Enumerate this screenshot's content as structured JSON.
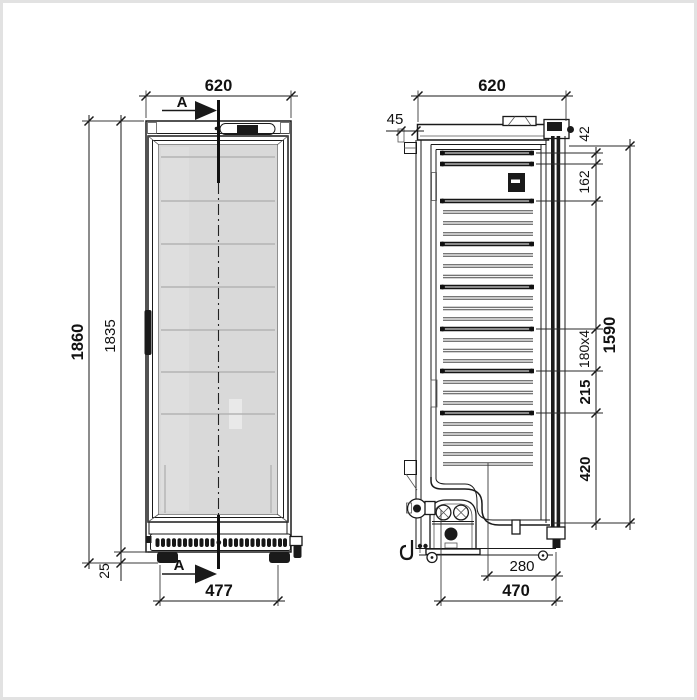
{
  "title": "refrigerator-dimension-drawing",
  "colors": {
    "ink": "#1a1a1a",
    "glass": "#d9d9d9",
    "paper": "#ffffff",
    "frame": "#e2e2e2"
  },
  "section_marker": {
    "label": "A"
  },
  "front_view": {
    "width": "620",
    "overall_height": "1860",
    "body_height": "1835",
    "foot_height": "25",
    "feet_span": "477"
  },
  "side_view": {
    "depth": "620",
    "wall_clearance": "45",
    "top_offset": "42",
    "upper_shelf_gap": "162",
    "shelf_pitch": "180x4",
    "lower_shelf_gap": "215",
    "bottom_zone": "420",
    "interior_height": "1590",
    "recess_depth": "280",
    "base_depth": "470"
  }
}
